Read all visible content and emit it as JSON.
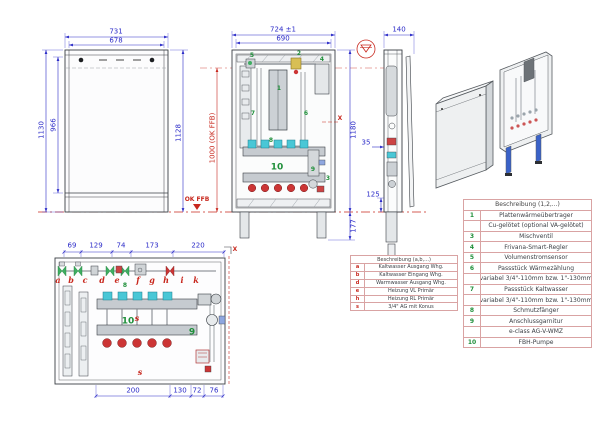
{
  "colors": {
    "dim_blue": "#2b2bc8",
    "mark_red": "#c8281e",
    "part_green": "#1f8f3a",
    "port_cyan": "#49c7d6",
    "port_red": "#cc3535"
  },
  "front_view": {
    "dim_width_outer": "731",
    "dim_width_inner": "678",
    "dim_height_outer": "1130",
    "dim_height_inner": "966",
    "dim_height_right": "1128",
    "dim_ffb": "1000 (OK FFB)",
    "datum_label": "OK FFB"
  },
  "open_view": {
    "dim_width_outer": "724 ±1",
    "dim_width_inner": "690",
    "dim_height": "1180",
    "dim_legs": "177",
    "section_label": "X",
    "labels": {
      "n1": "1",
      "n2": "2",
      "n3": "3",
      "n4": "4",
      "n5": "5",
      "n6": "6",
      "n7": "7",
      "n8": "8",
      "n9": "9",
      "n10": "10"
    }
  },
  "side_view": {
    "dim_depth": "140",
    "dim_offset": "35",
    "dim_bottom": "125"
  },
  "plan_view": {
    "dims_top": [
      "69",
      "129",
      "74",
      "173",
      "220"
    ],
    "dims_bottom": [
      "200",
      "130",
      "72",
      "76"
    ],
    "letters": [
      "a",
      "b",
      "c",
      "d",
      "e",
      "f",
      "g",
      "h",
      "i",
      "k"
    ],
    "green_labels": {
      "n8": "8",
      "n9": "9",
      "n10": "10"
    },
    "s_label": "s",
    "section_label": "X"
  },
  "legend_letters": {
    "title": "Beschreibung (a,b,...)",
    "rows": [
      {
        "key": "a",
        "text": "Kaltwasser Ausgang Whg."
      },
      {
        "key": "b",
        "text": "Kaltwasser Eingang Whg."
      },
      {
        "key": "d",
        "text": "Warmwasser Ausgang Whg."
      },
      {
        "key": "e",
        "text": "Heizung VL Primär"
      },
      {
        "key": "h",
        "text": "Heizung RL Primär"
      },
      {
        "key": "s",
        "text": "3/4\" AG mit Konus"
      }
    ]
  },
  "legend_numbers": {
    "title": "Beschreibung (1,2,...)",
    "rows": [
      {
        "key": "1",
        "text": "Plattenwärmeübertrager"
      },
      {
        "key": "",
        "text": "Cu-gelötet (optional VA-gelötet)"
      },
      {
        "key": "3",
        "text": "Mischventil"
      },
      {
        "key": "4",
        "text": "Frivana-Smart-Regler"
      },
      {
        "key": "5",
        "text": "Volumenstromsensor"
      },
      {
        "key": "6",
        "text": "Passstück Wärmezählung"
      },
      {
        "key": "",
        "text": "variabel 3/4\"-110mm bzw. 1\"-130mm"
      },
      {
        "key": "7",
        "text": "Passstück Kaltwasser"
      },
      {
        "key": "",
        "text": "variabel 3/4\"-110mm bzw. 1\"-130mm"
      },
      {
        "key": "8",
        "text": "Schmutzfänger"
      },
      {
        "key": "9",
        "text": "Anschlussgarnitur"
      },
      {
        "key": "",
        "text": "e-class AG-V-WMZ"
      },
      {
        "key": "10",
        "text": "FBH-Pumpe"
      }
    ]
  }
}
